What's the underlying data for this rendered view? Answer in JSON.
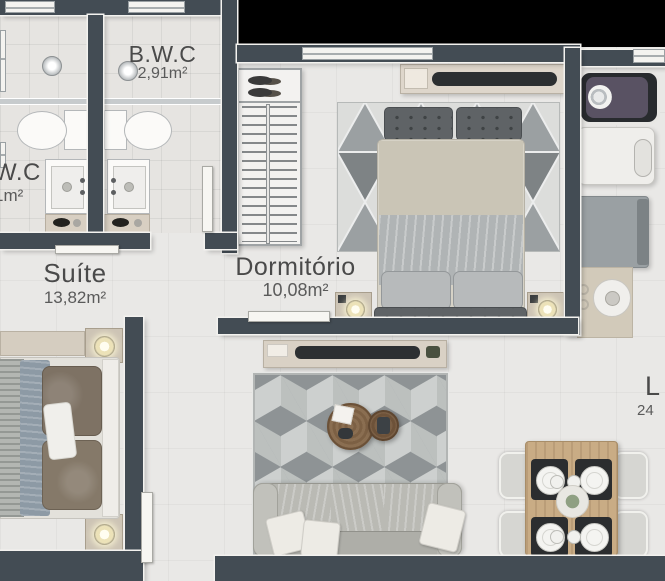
{
  "rooms": {
    "wc": {
      "label": "W.C",
      "area": "1m²"
    },
    "bwc": {
      "label": "B.W.C",
      "area": "2,91m²"
    },
    "suite": {
      "label": "Suíte",
      "area": "13,82m²"
    },
    "dormitorio": {
      "label": "Dormitório",
      "area": "10,08m²"
    },
    "living": {
      "label": "L",
      "area": "24"
    }
  },
  "colors": {
    "wall": "#434c54",
    "floor": "#e9e8e6",
    "outside": "#000000",
    "trim": "#f3f2ef",
    "wood_rack": "#d9d1c5",
    "wood_dining": "#c9ac85",
    "label_text": "#4a4a4a"
  }
}
